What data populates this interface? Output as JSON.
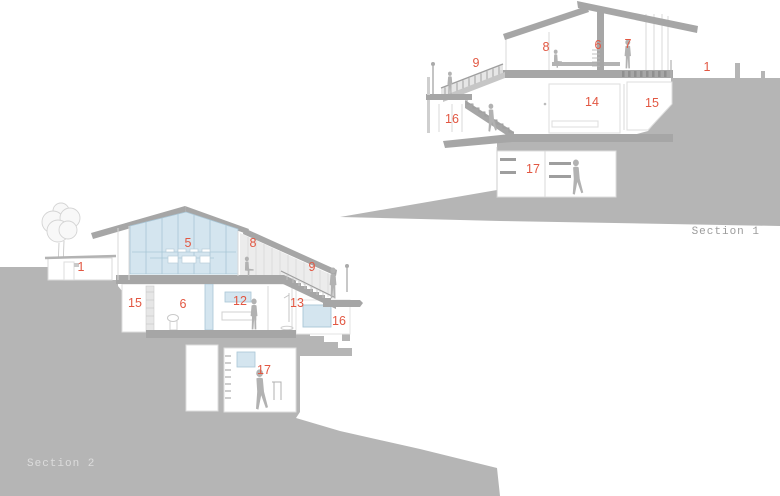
{
  "palette": {
    "hill": "#b5b5b5",
    "structure": "#a6a6a6",
    "glass": "#d4e5ef",
    "glass_line": "#a9c6d6",
    "label_red": "#e25742",
    "title_gray": "#9c9c9c",
    "title_light": "#dcdcdc",
    "figure": "#b2b2b2"
  },
  "section1": {
    "title": "Section 1",
    "labels": {
      "n1": "1",
      "n6": "6",
      "n7": "7",
      "n8": "8",
      "n9": "9",
      "n14": "14",
      "n15": "15",
      "n16": "16",
      "n17": "17"
    }
  },
  "section2": {
    "title": "Section 2",
    "labels": {
      "n1": "1",
      "n5": "5",
      "n6": "6",
      "n8": "8",
      "n9": "9",
      "n12": "12",
      "n13": "13",
      "n15": "15",
      "n16": "16",
      "n17": "17"
    }
  }
}
